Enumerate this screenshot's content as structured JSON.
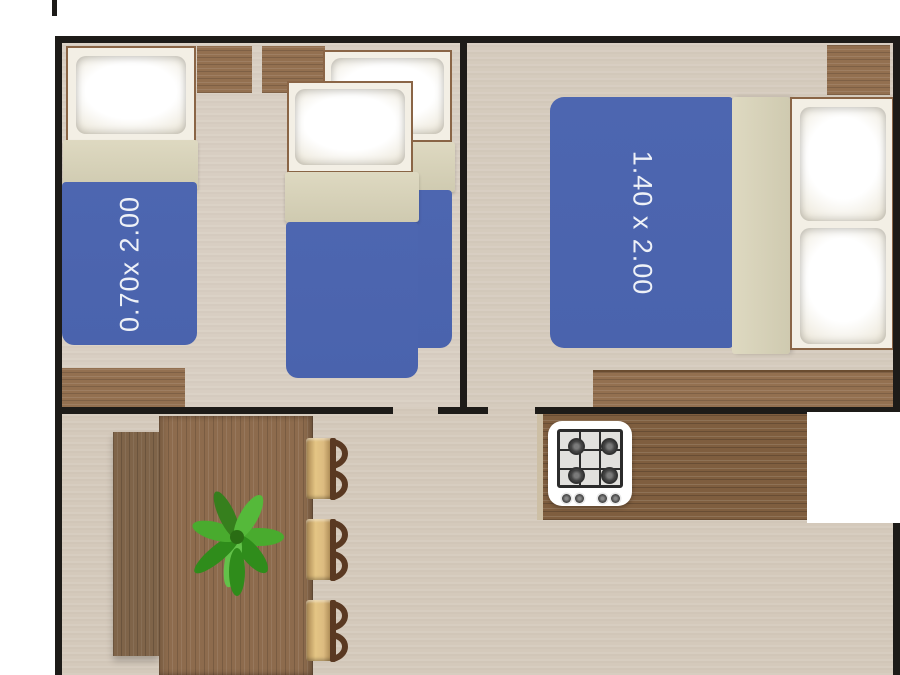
{
  "title": "mobile-home floor plan",
  "labels": {
    "single_bed": "0.70x 2.00",
    "double_bed": "1.40 x 2.00"
  },
  "rooms": {
    "bedroom_small": {
      "single_beds": 3,
      "wardrobes": 1,
      "shelves": 2
    },
    "bedroom_master": {
      "double_beds": 1,
      "nightstands": 1,
      "wardrobes": 1
    },
    "living_kitchen": {
      "chairs": 3,
      "table": 1,
      "bench": 1,
      "stove_burners": 4,
      "stove_knobs": 4,
      "plant": 1
    }
  },
  "colors": {
    "wall": "#1d1b18",
    "floor": "#d4c9bb",
    "blanket-blue": "#4a63ad",
    "blanket-fold": "#d7d2b7",
    "pillow-area": "#f3efe5",
    "frame-border": "#8a6546",
    "wood": "#937050",
    "wood-dark": "#7f5e3f",
    "table-wood": "#8d6b4d",
    "bench-wood": "#7f6449",
    "chair-seat": "#dcbb80",
    "chair-back": "#5a3922",
    "label-text": "#eef1f7",
    "plant-green": "#46a028",
    "stove-body": "#ffffff",
    "appliance-white": "#ffffff"
  }
}
